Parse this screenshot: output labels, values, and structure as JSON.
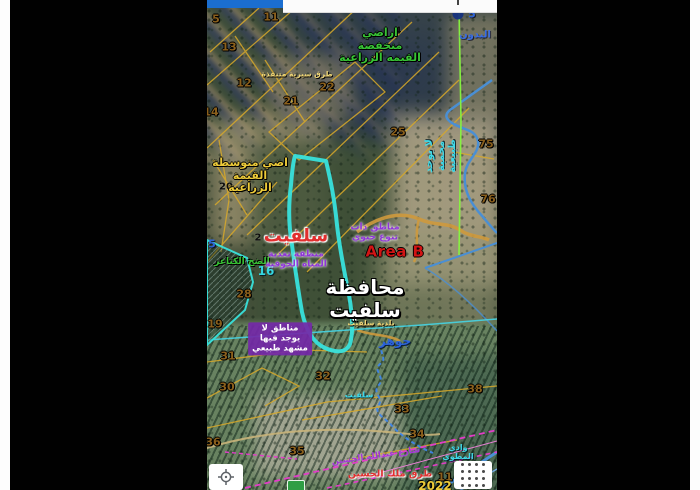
{
  "app": {
    "type": "mobile-satellite-map-screenshot",
    "statusbar": {
      "left_color": "#1b6ed0",
      "right_color": "#fbfbfb"
    }
  },
  "colors": {
    "highlight_polygon": "#38e2dc",
    "parcel_lines": "#d8a92a",
    "roads_blue": "#4a8fd4",
    "roads_orange": "#cf9a3d",
    "railway_magenta": "#e23cc8",
    "survey_line_green": "#86f53e",
    "letterbox": "#010101"
  },
  "controls": {
    "locate_button_icon": "crosshair-icon",
    "apps_button_icon": "grid-icon"
  },
  "map": {
    "labels": [
      {
        "name": "parcel-number",
        "text": "5",
        "x": 9,
        "y": 20,
        "cls": "num"
      },
      {
        "name": "parcel-number",
        "text": "11",
        "x": 64,
        "y": 18,
        "cls": "num"
      },
      {
        "name": "parcel-number",
        "text": "13",
        "x": 22,
        "y": 48,
        "cls": "num"
      },
      {
        "name": "parcel-number",
        "text": "12",
        "x": 37,
        "y": 84,
        "cls": "num"
      },
      {
        "name": "parcel-number",
        "text": "22",
        "x": 120,
        "y": 88,
        "cls": "num"
      },
      {
        "name": "parcel-number",
        "text": "21",
        "x": 84,
        "y": 102,
        "cls": "num"
      },
      {
        "name": "parcel-number",
        "text": "14",
        "x": 4,
        "y": 113,
        "cls": "num"
      },
      {
        "name": "parcel-number",
        "text": "25",
        "x": 191,
        "y": 133,
        "cls": "num"
      },
      {
        "name": "parcel-number",
        "text": "75",
        "x": 279,
        "y": 145,
        "cls": "num"
      },
      {
        "name": "parcel-number",
        "text": "76",
        "x": 281,
        "y": 200,
        "cls": "num"
      },
      {
        "name": "parcel-number",
        "text": "28",
        "x": 37,
        "y": 295,
        "cls": "num"
      },
      {
        "name": "parcel-number",
        "text": "19",
        "x": 8,
        "y": 325,
        "cls": "num"
      },
      {
        "name": "parcel-number",
        "text": "31",
        "x": 21,
        "y": 357,
        "cls": "num"
      },
      {
        "name": "parcel-number",
        "text": "30",
        "x": 20,
        "y": 388,
        "cls": "num"
      },
      {
        "name": "parcel-number",
        "text": "32",
        "x": 116,
        "y": 377,
        "cls": "num"
      },
      {
        "name": "parcel-number",
        "text": "33",
        "x": 195,
        "y": 410,
        "cls": "num"
      },
      {
        "name": "parcel-number",
        "text": "38",
        "x": 268,
        "y": 390,
        "cls": "num"
      },
      {
        "name": "parcel-number",
        "text": "36",
        "x": 6,
        "y": 443,
        "cls": "num"
      },
      {
        "name": "parcel-number",
        "text": "35",
        "x": 90,
        "y": 452,
        "cls": "num"
      },
      {
        "name": "parcel-number",
        "text": "34",
        "x": 210,
        "y": 435,
        "cls": "num"
      },
      {
        "name": "parcel-number",
        "text": "11",
        "x": 238,
        "y": 478,
        "cls": "num"
      },
      {
        "name": "parcel-number",
        "text": "4",
        "x": 191,
        "y": 31,
        "cls": "num-black"
      },
      {
        "name": "parcel-number",
        "text": "2",
        "x": 51,
        "y": 238,
        "cls": "num-black"
      },
      {
        "name": "parcel-number",
        "text": "20",
        "x": 19,
        "y": 187,
        "cls": "num-black"
      },
      {
        "name": "parcel-number",
        "text": "5",
        "x": 5,
        "y": 245,
        "cls": "num-blue"
      },
      {
        "name": "parcel-number",
        "text": "5",
        "x": 265,
        "y": 15,
        "cls": "num-blue"
      },
      {
        "name": "parcel-number",
        "text": "16",
        "x": 59,
        "y": 272,
        "cls": "num-cyan"
      },
      {
        "name": "label-low-agri-value",
        "text": "اراضي\nمنخفضة\nالقيمه الزراعية",
        "x": 173,
        "y": 46,
        "cls": "green-lbl"
      },
      {
        "name": "label-paths-top",
        "text": "طرق سيرية متنفذة",
        "x": 90,
        "y": 75,
        "cls": "yellow-sm"
      },
      {
        "name": "label-mid-agri-value",
        "text": "اضي متوسطة\nالقيمة\nالزراعية",
        "x": 43,
        "y": 176,
        "cls": "yellow-lbl"
      },
      {
        "name": "label-kanaer",
        "text": "الضخ الكناعر",
        "x": 35,
        "y": 262,
        "cls": "green-sm"
      },
      {
        "name": "label-salfit-red",
        "text": "سلفيت",
        "x": 89,
        "y": 237,
        "cls": "red-big"
      },
      {
        "name": "label-groundwater",
        "text": "منطقة تغذية\nالمياه الجوفية",
        "x": 89,
        "y": 260,
        "cls": "purple-lbl"
      },
      {
        "name": "label-biodiversity",
        "text": "مناطق ذات\nتنوع حيوي",
        "x": 168,
        "y": 233,
        "cls": "purple-lbl"
      },
      {
        "name": "label-area-b",
        "text": "Area B",
        "x": 188,
        "y": 252,
        "cls": "areab"
      },
      {
        "name": "label-no-reserve",
        "text": "لا يوجد\nمحمية\nطبيعية",
        "x": 234,
        "y": 156,
        "cls": "cyan-lbl",
        "rot": -90
      },
      {
        "name": "label-bedouin",
        "text": "البدون",
        "x": 268,
        "y": 35,
        "cls": "blue-lbl"
      },
      {
        "name": "label-governorate",
        "text": "محافظة سلفيت",
        "x": 158,
        "y": 299,
        "cls": "white-big"
      },
      {
        "name": "label-municipality",
        "text": "بلدية سلفيت",
        "x": 164,
        "y": 324,
        "cls": "yellow-sm"
      },
      {
        "name": "label-no-landscape",
        "text": "مناطق لا\nيوجد فيها\nمشهد طبيعي",
        "x": 73,
        "y": 339,
        "cls": "chip"
      },
      {
        "name": "label-jawhar",
        "text": "جوهر",
        "x": 188,
        "y": 342,
        "cls": "blue-bold"
      },
      {
        "name": "label-salfit-cyan",
        "text": "سلفيت",
        "x": 152,
        "y": 395,
        "cls": "cyan-sm"
      },
      {
        "name": "label-street",
        "text": "شارع عبدالله الحسين",
        "x": 169,
        "y": 457,
        "cls": "purple-rd",
        "rot": -8
      },
      {
        "name": "label-king-road",
        "text": "طرق ملك الحسين",
        "x": 183,
        "y": 475,
        "cls": "red-sm"
      },
      {
        "name": "label-year",
        "text": "2022",
        "x": 228,
        "y": 487,
        "cls": "yellow-big"
      },
      {
        "name": "label-wadi",
        "text": "وادي المطوي",
        "x": 251,
        "y": 452,
        "cls": "cyan-sm"
      }
    ]
  }
}
